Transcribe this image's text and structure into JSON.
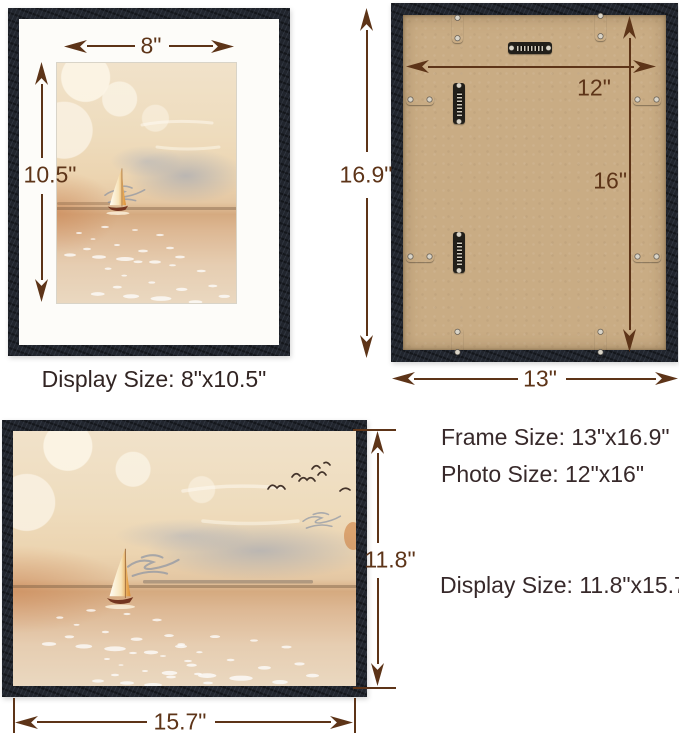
{
  "front_portrait": {
    "width_label": "8\"",
    "height_label": "10.5\"",
    "caption": "Display Size: 8\"x10.5\""
  },
  "back_view": {
    "frame_height_label": "16.9\"",
    "photo_width_label": "12\"",
    "photo_height_label": "16\"",
    "frame_width_label": "13\"",
    "hardware": [
      "sawtooth-hanger",
      "retainer-clip"
    ]
  },
  "front_landscape": {
    "height_label": "11.8\"",
    "width_label": "15.7\""
  },
  "specs": {
    "frame_size": "Frame Size: 13\"x16.9\"",
    "photo_size": "Photo Size: 12\"x16\"",
    "display_size": "Display Size: 11.8\"x15.7\""
  },
  "colors": {
    "dimension_annotation": "#5d3418",
    "spec_text": "#37292a",
    "frame_wood": "#21252d",
    "backing_board": "#c9ac84",
    "mat_board": "#fdfcf9"
  }
}
